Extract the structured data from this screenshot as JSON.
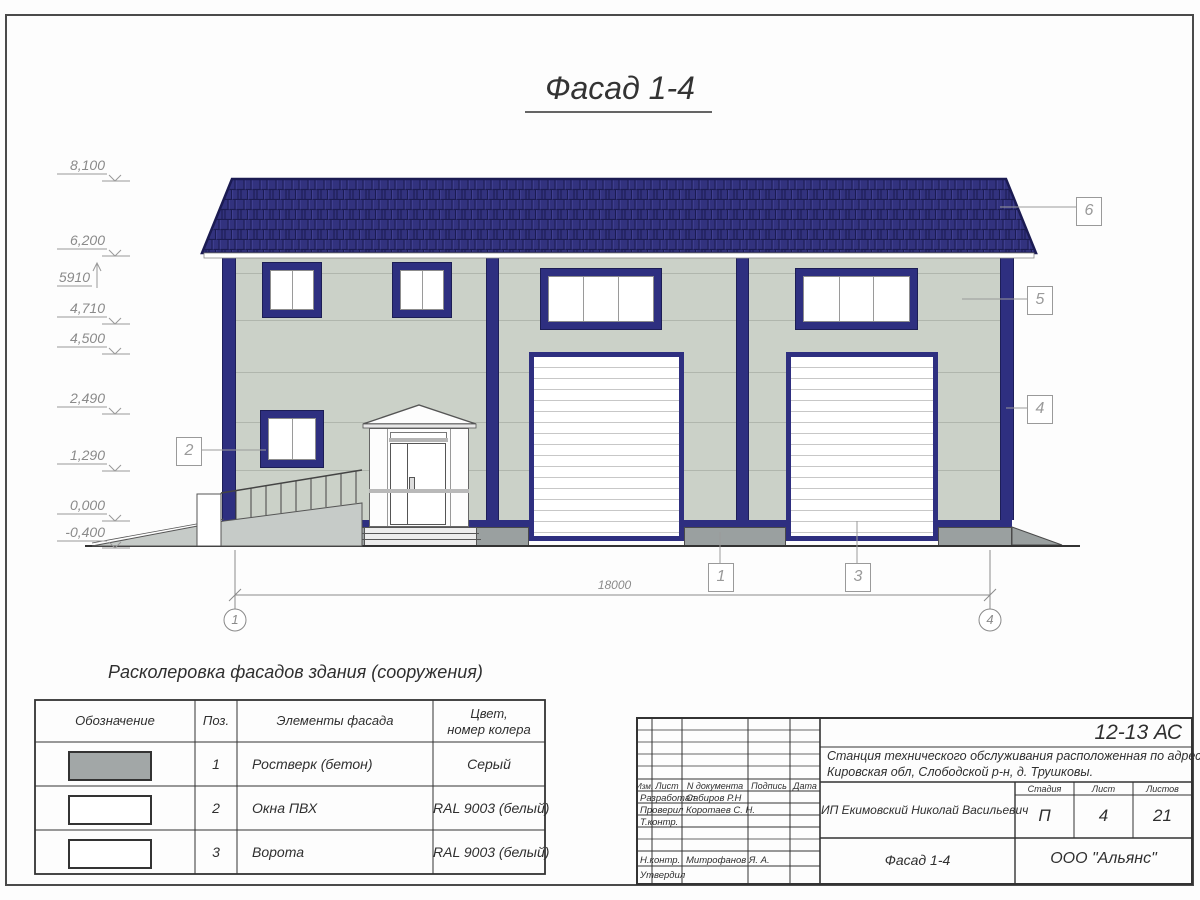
{
  "sheet_title": "Фасад 1-4",
  "elevations": [
    {
      "value": "8,100"
    },
    {
      "value": "6,200"
    },
    {
      "value": "5910"
    },
    {
      "value": "4,710"
    },
    {
      "value": "4,500"
    },
    {
      "value": "2,490"
    },
    {
      "value": "1,290"
    },
    {
      "value": "0,000"
    },
    {
      "value": "-0,400"
    }
  ],
  "callouts": [
    {
      "num": "1"
    },
    {
      "num": "2"
    },
    {
      "num": "3"
    },
    {
      "num": "4"
    },
    {
      "num": "5"
    },
    {
      "num": "6"
    }
  ],
  "dimension": {
    "value": "18000"
  },
  "axes": [
    {
      "num": "1"
    },
    {
      "num": "4"
    }
  ],
  "color_table": {
    "title": "Расколеровка фасадов здания (сооружения)",
    "headers": {
      "designation": "Обозначение",
      "pos": "Поз.",
      "element": "Элементы фасада",
      "color_line1": "Цвет,",
      "color_line2": "номер колера"
    },
    "rows": [
      {
        "pos": "1",
        "element": "Ростверк (бетон)",
        "color": "Серый",
        "swatch": "#a2a7a7"
      },
      {
        "pos": "2",
        "element": "Окна ПВХ",
        "color": "RAL 9003 (белый)",
        "swatch": "#ffffff"
      },
      {
        "pos": "3",
        "element": "Ворота",
        "color": "RAL 9003 (белый)",
        "swatch": "#ffffff"
      }
    ]
  },
  "title_block": {
    "doc_code": "12-13 АС",
    "project_line1": "Станция технического обслуживания расположенная по адресу",
    "project_line2": "Кировская обл, Слободской р-н, д. Трушковы.",
    "client": "ИП Екимовский Николай Васильевич",
    "sheet_name": "Фасад 1-4",
    "organization": "ООО \"Альянс\"",
    "stage_label": "Стадия",
    "sheet_label": "Лист",
    "sheets_label": "Листов",
    "stage": "П",
    "sheet_no": "4",
    "sheets_total": "21",
    "cols": {
      "izm": "Изм.",
      "list": "Лист",
      "doc": "N документа",
      "sign": "Подпись",
      "date": "Дата"
    },
    "roles": [
      {
        "role": "Разработал",
        "name": "Сабиров Р.Н"
      },
      {
        "role": "Проверил",
        "name": "Коротаев С. Н."
      },
      {
        "role": "Т.контр.",
        "name": ""
      },
      {
        "role": "Н.контр.",
        "name": "Митрофанов Я. А."
      },
      {
        "role": "Утвердил",
        "name": ""
      }
    ]
  },
  "colors": {
    "roof_navy": "#32327e",
    "frame_navy": "#2e2f80",
    "wall_sage": "#cbd1c8",
    "plinth_gray": "#9aa0a0"
  }
}
